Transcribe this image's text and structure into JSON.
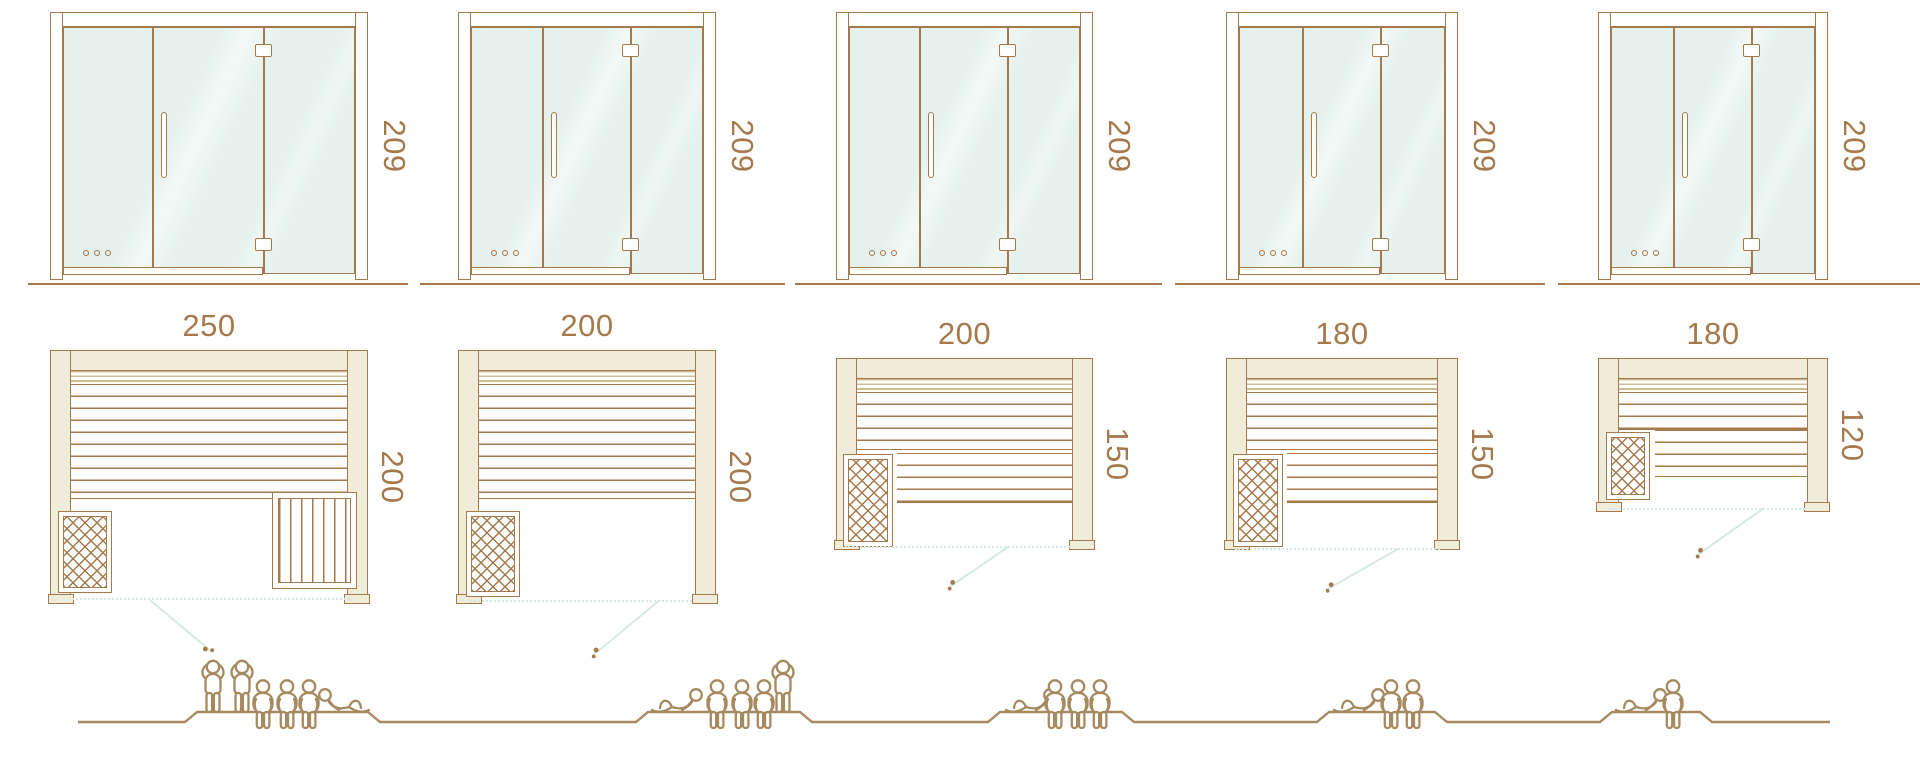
{
  "diagram": {
    "name": "sauna-size-comparison",
    "colors": {
      "outline_brown": "#a5794b",
      "wall_beige": "#f0ecda",
      "glass_mint": "#e4f1ed",
      "door_swing_line": "#d6e9e3",
      "people_brown": "#a6895f",
      "dimension_text": "#a5794b"
    },
    "models": [
      {
        "name": "sauna-250x200",
        "front_height": "209",
        "width_label": "250",
        "depth_label": "200",
        "capacity": {
          "standing": 2,
          "sitting": 3,
          "lying": 1,
          "total": 6
        },
        "features": {
          "heater": "bottom-left",
          "corner_bench": true,
          "lower_bench": false,
          "door_swing": "right"
        }
      },
      {
        "name": "sauna-200x200",
        "front_height": "209",
        "width_label": "200",
        "depth_label": "200",
        "capacity": {
          "standing": 1,
          "sitting": 3,
          "lying": 1,
          "total": 5
        },
        "features": {
          "heater": "bottom-left",
          "corner_bench": false,
          "lower_bench": false,
          "door_swing": "left"
        }
      },
      {
        "name": "sauna-200x150",
        "front_height": "209",
        "width_label": "200",
        "depth_label": "150",
        "capacity": {
          "standing": 0,
          "sitting": 3,
          "lying": 1,
          "total": 4
        },
        "features": {
          "heater": "bottom-left",
          "corner_bench": false,
          "lower_bench": true,
          "door_swing": "left"
        }
      },
      {
        "name": "sauna-180x150",
        "front_height": "209",
        "width_label": "180",
        "depth_label": "150",
        "capacity": {
          "standing": 0,
          "sitting": 2,
          "lying": 1,
          "total": 3
        },
        "features": {
          "heater": "bottom-left",
          "corner_bench": false,
          "lower_bench": true,
          "door_swing": "left"
        }
      },
      {
        "name": "sauna-180x120",
        "front_height": "209",
        "width_label": "180",
        "depth_label": "120",
        "capacity": {
          "standing": 0,
          "sitting": 1,
          "lying": 1,
          "total": 2
        },
        "features": {
          "heater": "bottom-left",
          "corner_bench": false,
          "lower_bench": true,
          "door_swing": "left"
        }
      }
    ]
  }
}
